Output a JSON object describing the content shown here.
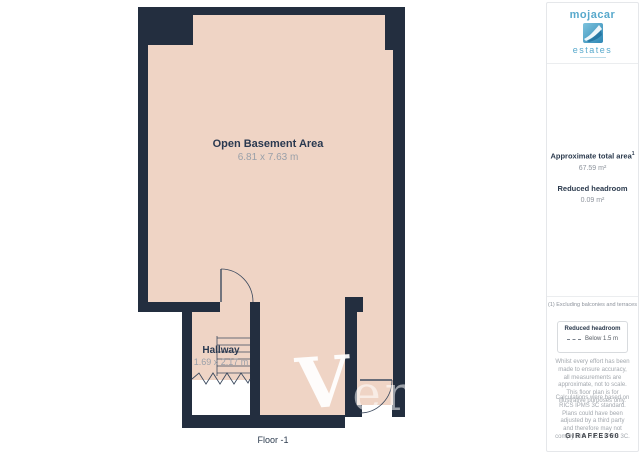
{
  "plan": {
    "rooms": [
      {
        "name": "Open Basement Area",
        "dimensions": "6.81 x 7.63 m"
      },
      {
        "name": "Hallway",
        "dimensions": "1.69 x 2.17 m"
      }
    ],
    "floor_label": "Floor -1",
    "colors": {
      "wall": "#232e3f",
      "floor": "#efd4c5"
    }
  },
  "watermark": {
    "letter_main": "V",
    "letters_rest": "eri"
  },
  "sidebar": {
    "logo": {
      "brand": "mojacar",
      "sub_brand": "estates"
    },
    "stats": [
      {
        "label": "Approximate total area",
        "superscript": "1",
        "value": "67.59 m²"
      },
      {
        "label": "Reduced headroom",
        "superscript": "",
        "value": "0.09 m²"
      }
    ],
    "footnote": "(1) Excluding balconies and terraces",
    "legend": {
      "title": "Reduced headroom",
      "item": "Below 1.5 m"
    },
    "disclaimer_1": "Whilst every effort has been made to ensure accuracy, all measurements are approximate, not to scale. This floor plan is for illustrative purposes only.",
    "disclaimer_2": "Calculations were based on RICS IPMS 3C standard. Plans could have been adjusted by a third party and therefore may not comply with RICS IPMS 3C.",
    "brand_footer": "GIRAFFE360"
  }
}
